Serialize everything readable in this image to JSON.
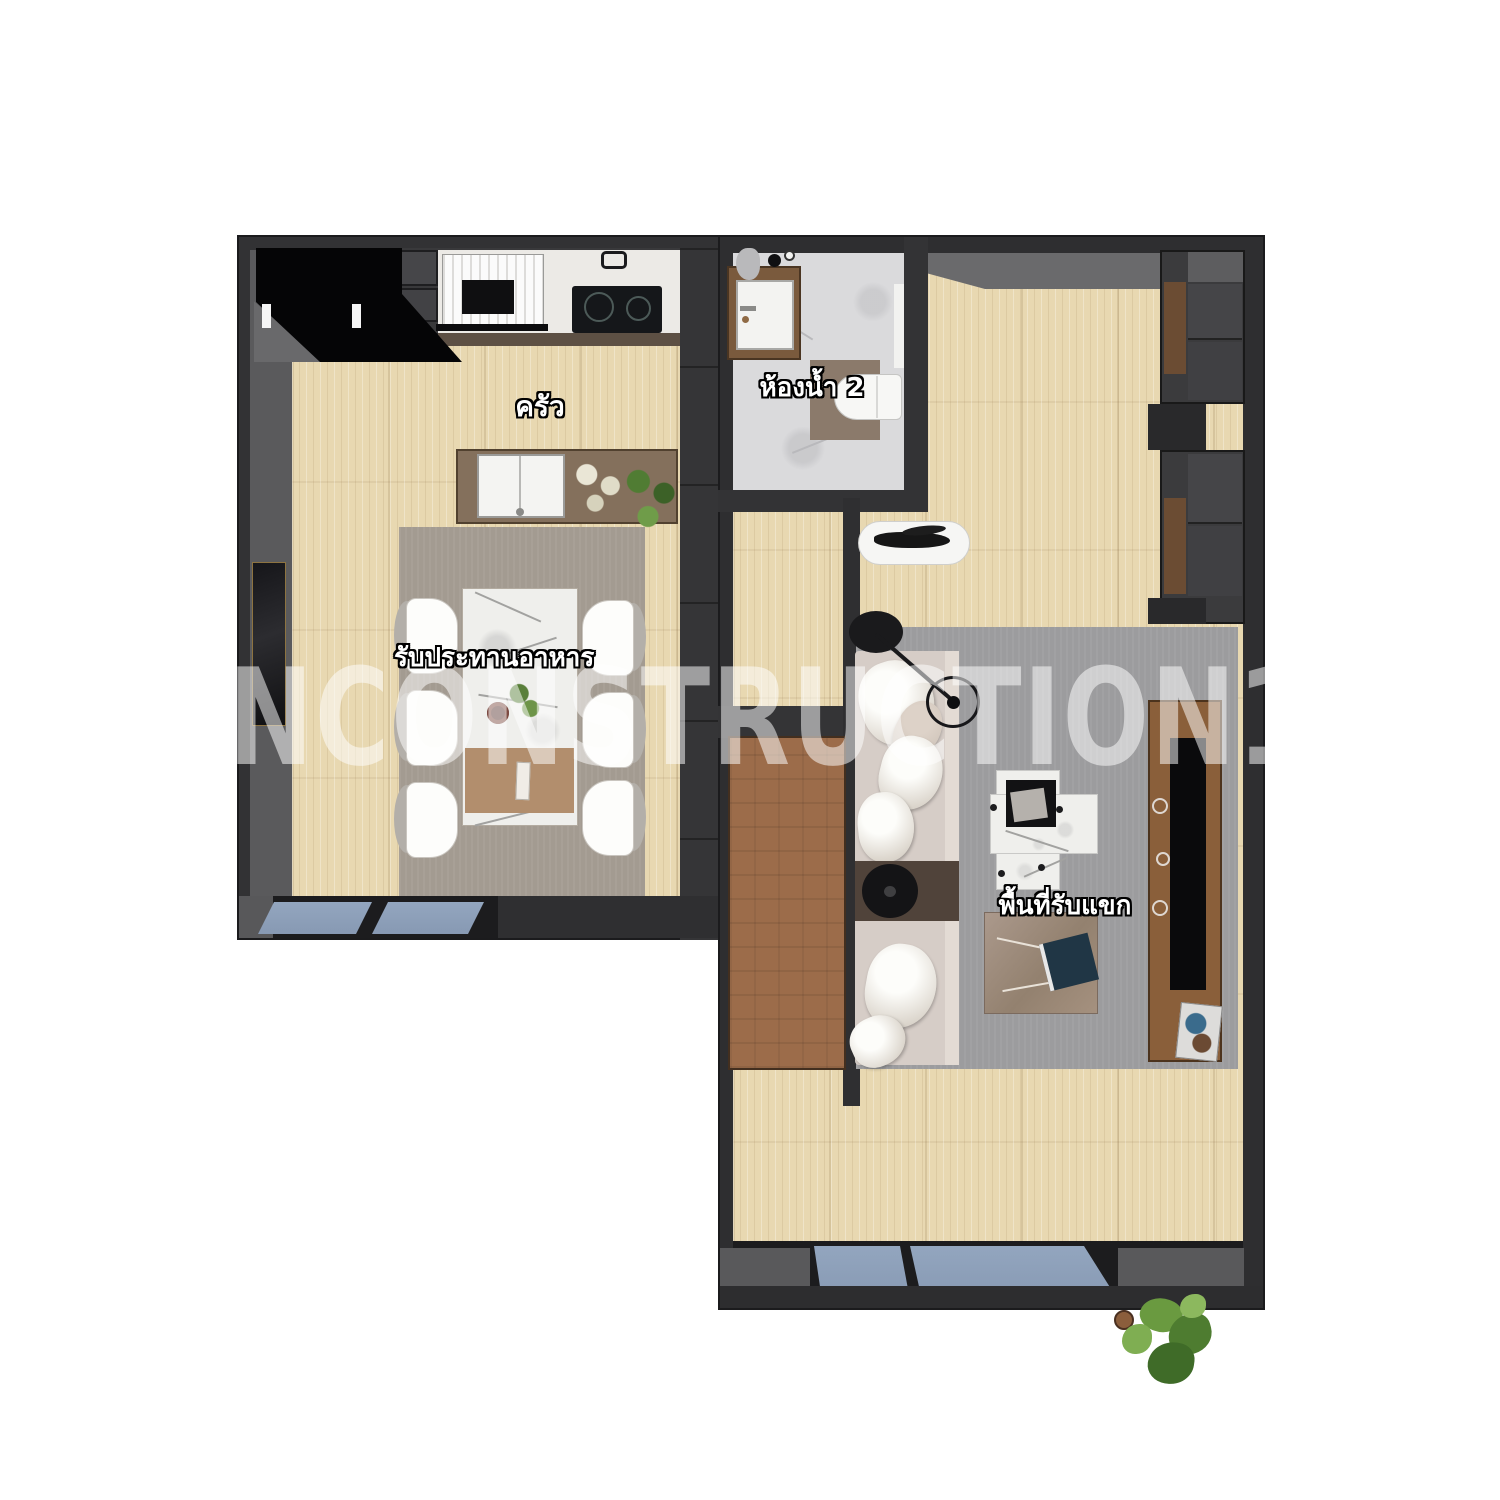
{
  "title": "apartment-floor-plan",
  "watermark": {
    "text": "NCONSTRUCTION1"
  },
  "rooms": {
    "kitchen": {
      "label": "ครัว"
    },
    "dining": {
      "label": "รับประทานอาหาร"
    },
    "bathroom": {
      "label": "ห้องน้ำ 2"
    },
    "living": {
      "label": "พื้นที่รับแขก"
    }
  },
  "palette": {
    "wall": "#2e2e30",
    "wall_inner": "#5a5a5c",
    "wood_floor": "#e8d8b1",
    "dining_rug": "#a39b91",
    "living_rug": "#9c9c9e",
    "bath_marble": "#dadadc",
    "window_glass": "#8ea1ba",
    "door_wood": "#9c6c4a",
    "island_wood": "#84705c",
    "table_runner": "#b28e6d",
    "sofa": "#d6cdc7",
    "tv_console_wood": "#8a5f3a",
    "fridge": "#050506",
    "plant_green": "#4f7a33"
  }
}
